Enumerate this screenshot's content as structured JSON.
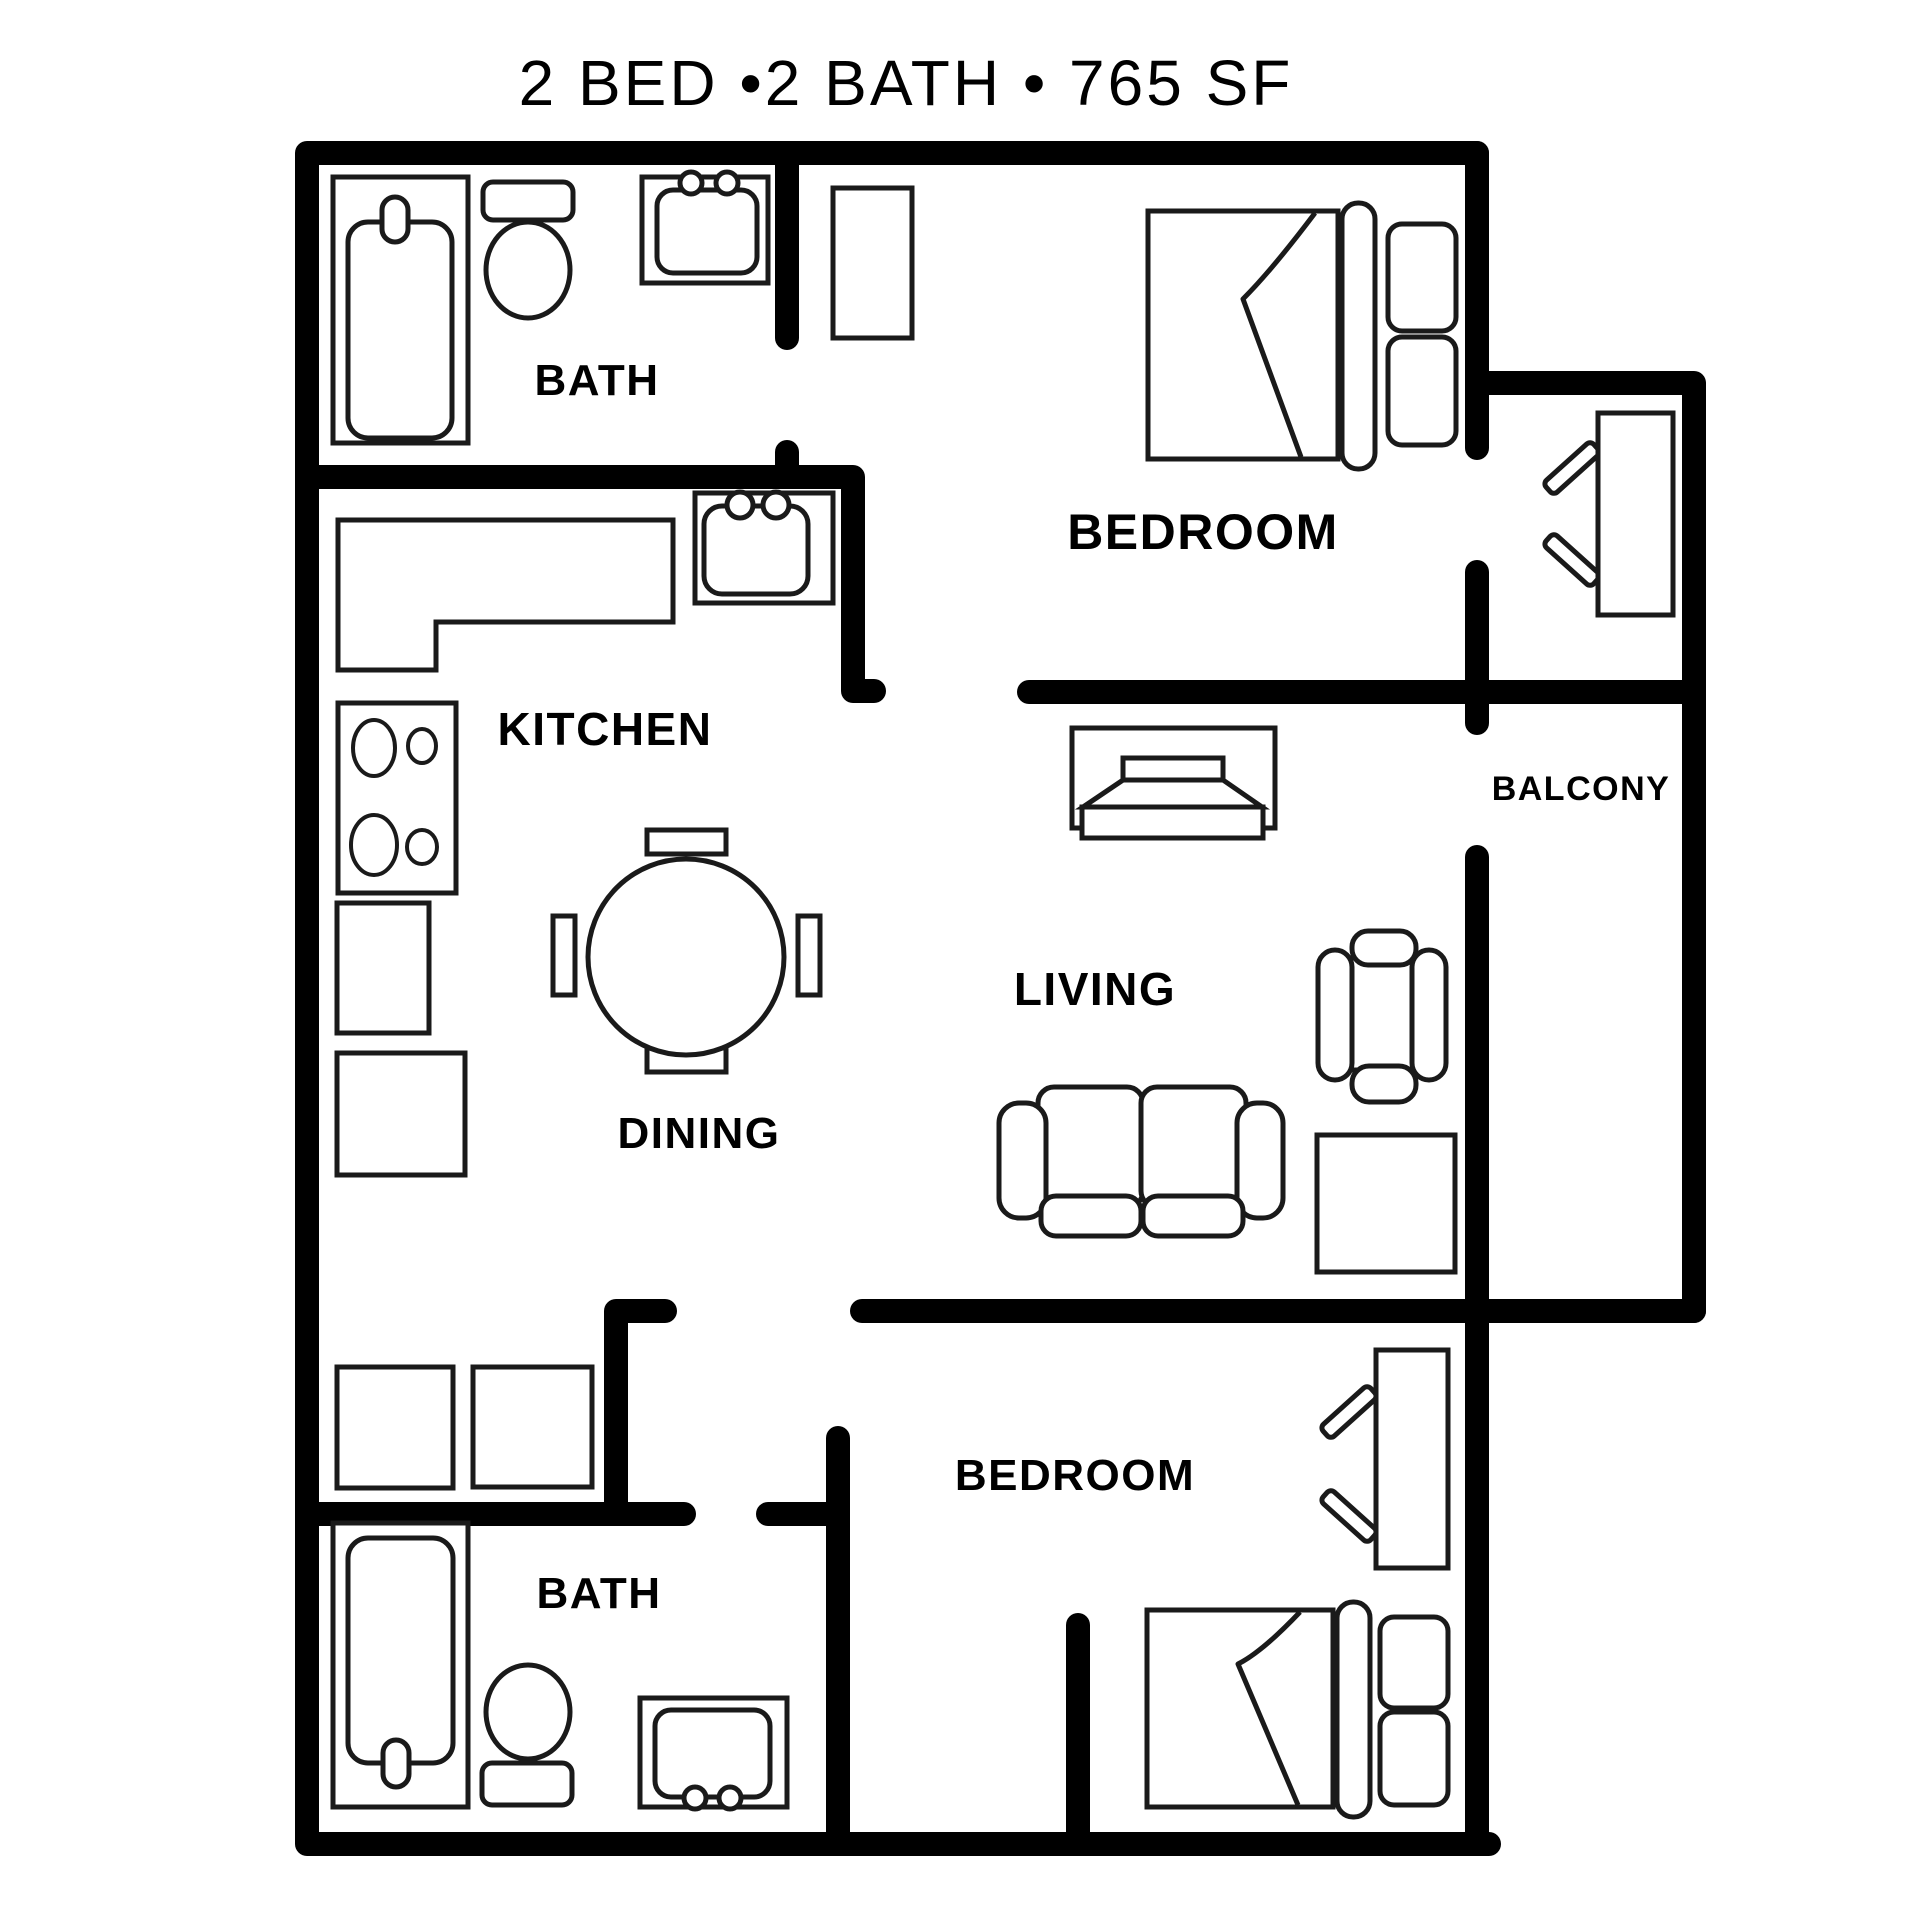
{
  "title": "2 BED •2 BATH • 765 SF",
  "colors": {
    "background": "#ffffff",
    "wall": "#000000",
    "furniture_line": "#1a1a1a",
    "text": "#000000"
  },
  "rooms": {
    "bath_top": "BATH",
    "bedroom_top": "BEDROOM",
    "kitchen": "KITCHEN",
    "balcony": "BALCONY",
    "dining": "DINING",
    "living": "LIVING",
    "bedroom_bottom": "BEDROOM",
    "bath_bottom": "BATH"
  },
  "stats": {
    "beds": "2",
    "baths": "2",
    "square_feet": "765"
  },
  "furniture_icons": [
    "bathtub-icon",
    "toilet-icon",
    "vanity-sink-icon",
    "wardrobe-icon",
    "kitchen-counter-icon",
    "kitchen-sink-icon",
    "cooktop-icon",
    "refrigerator-icon",
    "cabinet-icon",
    "dining-table-icon",
    "dining-chair-icon",
    "queen-bed-icon",
    "pillow-icon",
    "tv-console-icon",
    "tv-icon",
    "armchair-icon",
    "loveseat-sofa-icon",
    "side-table-icon",
    "balcony-chair-icon",
    "bedroom-chair-icon",
    "storage-cabinet-icon"
  ]
}
